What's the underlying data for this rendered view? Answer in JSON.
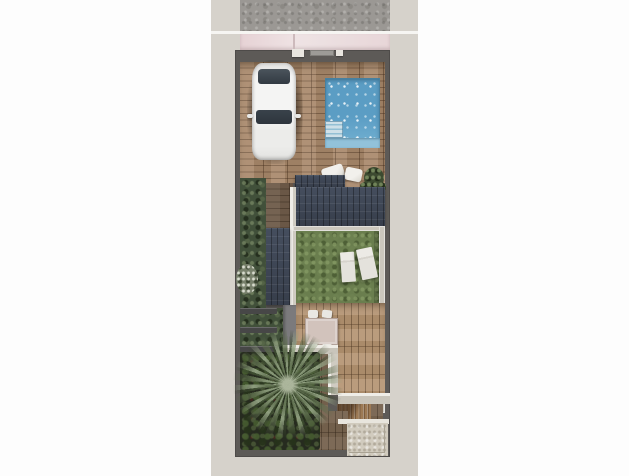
{
  "meta": {
    "kind": "architectural-render",
    "view": "top-down site plan of a narrow villa plot",
    "canvas": {
      "width": 629,
      "height": 476
    }
  },
  "palette": {
    "page_background": "#fdfdfd",
    "ground_band": "#d6d2cb",
    "sidewalk_concrete": "#9b9894",
    "boundary_wall_dark": "#5d5a57",
    "rear_wall_pink": "#e9d7d9",
    "deck_wood": "#a8886a",
    "terrace_wood": "#b39270",
    "roof_panels_navy": "#3e4654",
    "pool_water": "#68a9cc",
    "pool_steps": "#cfe0e8",
    "lawn_green": "#6a7e4e",
    "hedge_green": "#41503a",
    "planting_bed": "#262b1f",
    "palm_foliage": "#5c6c4c",
    "light_walls": "#cbc7bd",
    "gravel_pad": "#d1cbbe",
    "white_furniture": "#e9e7e2",
    "car_body": "#f1f1f0",
    "car_glass": "#3a424a",
    "dining_table_top": "#d2c3bc",
    "entry_floor_gray": "#7b7a7c",
    "stair_wood": "#9d7a55"
  },
  "objects": {
    "sidewalk": "concrete pavement strip along the street",
    "rear_wall": "pink-rendered street wall with gate elements",
    "car": "white car parked on the wooden driveway deck",
    "pool": "rectangular blue swimming pool with corner steps and bench",
    "pillows": "two white lounge cushions on the deck",
    "potted_plant": "dark green potted plant beside the pool deck",
    "roofs": "dark panelled flat roofs (porch, main house, garage wing)",
    "lawn": "courtyard lawn",
    "sun_loungers": "two white sun loungers on the lawn",
    "hedge": "green hedge strip along the left boundary",
    "path_steps": "timber sleeper steps on the side path",
    "dining_set": "outdoor dining table with four white chairs",
    "interior_walls": "light rendered garden walls",
    "staircase": "timber staircase to the lower level",
    "palm_tree": "large palm tree over a dark planting bed",
    "gravel_pad": "gravel utility pad at the bottom-right corner",
    "boundary": "dark perimeter wall of the plot"
  }
}
